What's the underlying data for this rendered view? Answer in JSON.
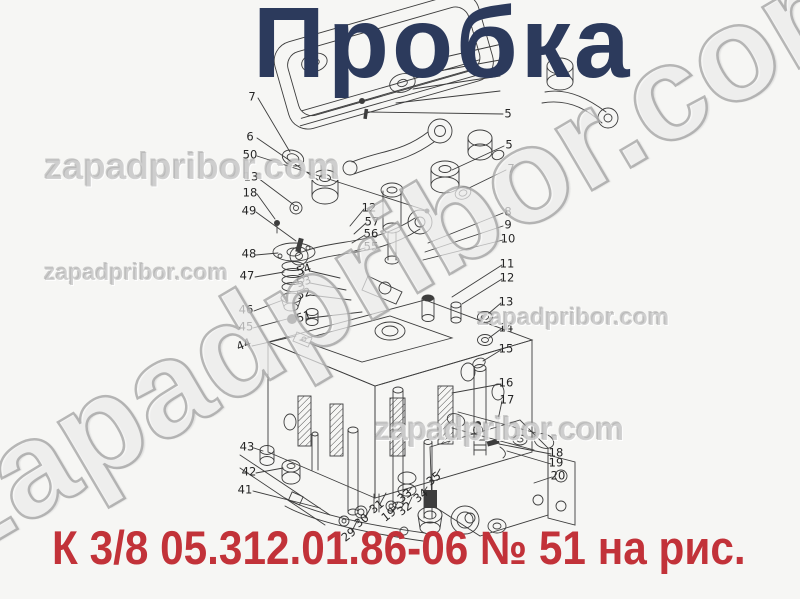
{
  "page": {
    "background": "#f6f6f4"
  },
  "title": {
    "text": "Пробка",
    "color": "#2c3a5c"
  },
  "caption": {
    "text": "К 3/8  05.312.01.86-06 № 51 на рис.",
    "color": "#c23239"
  },
  "watermarks": {
    "diagonal": "zapadpribor.com",
    "h1": "zapadpribor.com",
    "h2": "zapadpribor.com",
    "h3": "zapadpribor.com",
    "h4": "zapadpribor.com"
  },
  "diagram": {
    "type": "exploded-view parts drawing",
    "part_labels": [
      {
        "text": "7",
        "x": 252,
        "y": 97
      },
      {
        "text": "6",
        "x": 250,
        "y": 137
      },
      {
        "text": "50",
        "x": 250,
        "y": 155
      },
      {
        "text": "13",
        "x": 251,
        "y": 177
      },
      {
        "text": "18",
        "x": 250,
        "y": 193
      },
      {
        "text": "49",
        "x": 249,
        "y": 211
      },
      {
        "text": "48",
        "x": 249,
        "y": 254
      },
      {
        "text": "47",
        "x": 247,
        "y": 276
      },
      {
        "text": "46",
        "x": 246,
        "y": 310
      },
      {
        "text": "45",
        "x": 246,
        "y": 327
      },
      {
        "text": "44",
        "x": 244,
        "y": 345,
        "rot": -22
      },
      {
        "text": "43",
        "x": 247,
        "y": 447
      },
      {
        "text": "42",
        "x": 249,
        "y": 472
      },
      {
        "text": "41",
        "x": 245,
        "y": 490
      },
      {
        "text": "12",
        "x": 369,
        "y": 208
      },
      {
        "text": "57",
        "x": 372,
        "y": 222
      },
      {
        "text": "56",
        "x": 371,
        "y": 234
      },
      {
        "text": "55",
        "x": 371,
        "y": 247
      },
      {
        "text": "54",
        "x": 304,
        "y": 270,
        "rot": -18
      },
      {
        "text": "53",
        "x": 304,
        "y": 282,
        "rot": -18
      },
      {
        "text": "52",
        "x": 304,
        "y": 294,
        "rot": -18
      },
      {
        "text": "51",
        "x": 304,
        "y": 317,
        "rot": -18
      },
      {
        "text": "1",
        "x": 507,
        "y": 43
      },
      {
        "text": "5",
        "x": 508,
        "y": 114
      },
      {
        "text": "5",
        "x": 509,
        "y": 145
      },
      {
        "text": "7",
        "x": 511,
        "y": 169
      },
      {
        "text": "8",
        "x": 508,
        "y": 212
      },
      {
        "text": "9",
        "x": 508,
        "y": 225
      },
      {
        "text": "10",
        "x": 508,
        "y": 239
      },
      {
        "text": "11",
        "x": 507,
        "y": 264
      },
      {
        "text": "12",
        "x": 507,
        "y": 278
      },
      {
        "text": "13",
        "x": 506,
        "y": 302
      },
      {
        "text": "14",
        "x": 506,
        "y": 328
      },
      {
        "text": "15",
        "x": 506,
        "y": 349
      },
      {
        "text": "16",
        "x": 506,
        "y": 383
      },
      {
        "text": "17",
        "x": 507,
        "y": 400
      },
      {
        "text": "18",
        "x": 556,
        "y": 453
      },
      {
        "text": "19",
        "x": 556,
        "y": 463
      },
      {
        "text": "20",
        "x": 558,
        "y": 476
      },
      {
        "text": "29",
        "x": 349,
        "y": 535,
        "rot": -38
      },
      {
        "text": "30",
        "x": 362,
        "y": 521,
        "rot": -38
      },
      {
        "text": "31",
        "x": 377,
        "y": 507,
        "rot": -38
      },
      {
        "text": "19",
        "x": 389,
        "y": 515,
        "rot": -38
      },
      {
        "text": "32",
        "x": 405,
        "y": 509,
        "rot": -38
      },
      {
        "text": "33",
        "x": 405,
        "y": 496,
        "rot": -38
      },
      {
        "text": "34",
        "x": 421,
        "y": 496,
        "rot": -38
      },
      {
        "text": "35",
        "x": 434,
        "y": 479,
        "rot": -38
      }
    ]
  }
}
